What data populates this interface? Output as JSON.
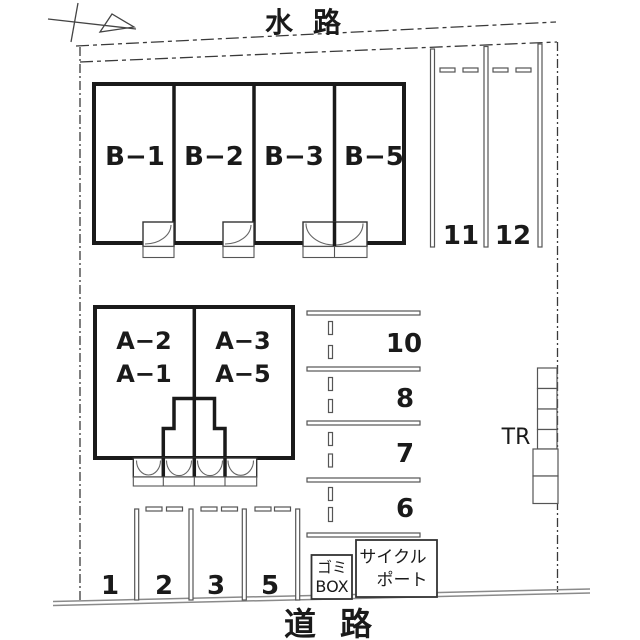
{
  "colors": {
    "ink": "#1a1a1a",
    "boundary": "#3a3a3a",
    "parking_line": "#555555",
    "road_line": "#8a8a8a",
    "background": "#ffffff"
  },
  "labels": {
    "waterway": "水路",
    "road": "道路"
  },
  "building_b": {
    "units": [
      {
        "label": "B−1"
      },
      {
        "label": "B−2"
      },
      {
        "label": "B−3"
      },
      {
        "label": "B−5"
      }
    ]
  },
  "building_a": {
    "left": {
      "line1": "A−2",
      "line2": "A−1"
    },
    "right": {
      "line1": "A−3",
      "line2": "A−5"
    }
  },
  "parking": {
    "top_right": {
      "spaces": [
        "11",
        "12"
      ]
    },
    "middle": {
      "spaces": [
        "10",
        "8",
        "7",
        "6"
      ]
    },
    "bottom": {
      "spaces": [
        "1",
        "2",
        "3",
        "5"
      ]
    }
  },
  "facilities": {
    "trash_box": {
      "line1": "ゴミ",
      "line2": "BOX"
    },
    "cycle_port": {
      "line1": "サイクル",
      "line2": "ポート"
    },
    "trunk_room": "TR"
  }
}
